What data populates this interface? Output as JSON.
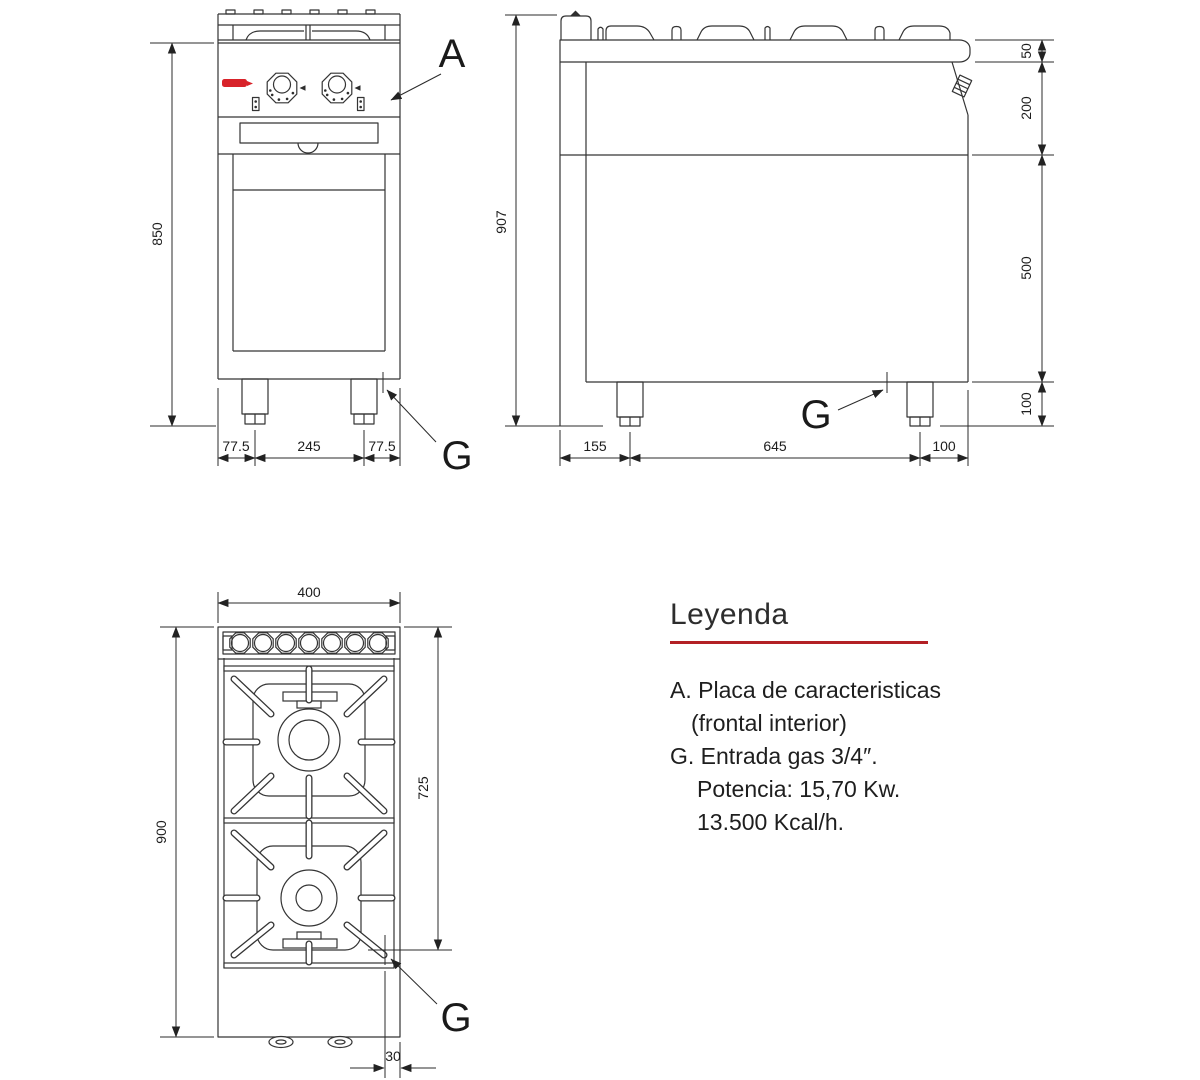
{
  "front_view": {
    "dim_height": "850",
    "dims_bottom": [
      "77.5",
      "245",
      "77.5"
    ],
    "callout_a": "A",
    "callout_g": "G"
  },
  "side_view": {
    "dim_height": "907",
    "dims_right": [
      "50",
      "200",
      "500",
      "100"
    ],
    "dims_bottom": [
      "155",
      "645",
      "100"
    ],
    "callout_g": "G"
  },
  "top_view": {
    "dim_width": "400",
    "dim_height": "900",
    "dim_inner": "725",
    "dim_offset": "30",
    "callout_g": "G"
  },
  "legend": {
    "title": "Leyenda",
    "items": [
      {
        "text": "A. Placa de caracteristicas"
      },
      {
        "text": "(frontal interior)"
      },
      {
        "text": "G. Entrada gas 3/4″."
      },
      {
        "text": "Potencia: 15,70 Kw."
      },
      {
        "text": "13.500 Kcal/h."
      }
    ]
  },
  "colors": {
    "line": "#343434",
    "text": "#1e1e1e",
    "accent_red_rule": "#b32025",
    "logo_red": "#d8232a"
  }
}
